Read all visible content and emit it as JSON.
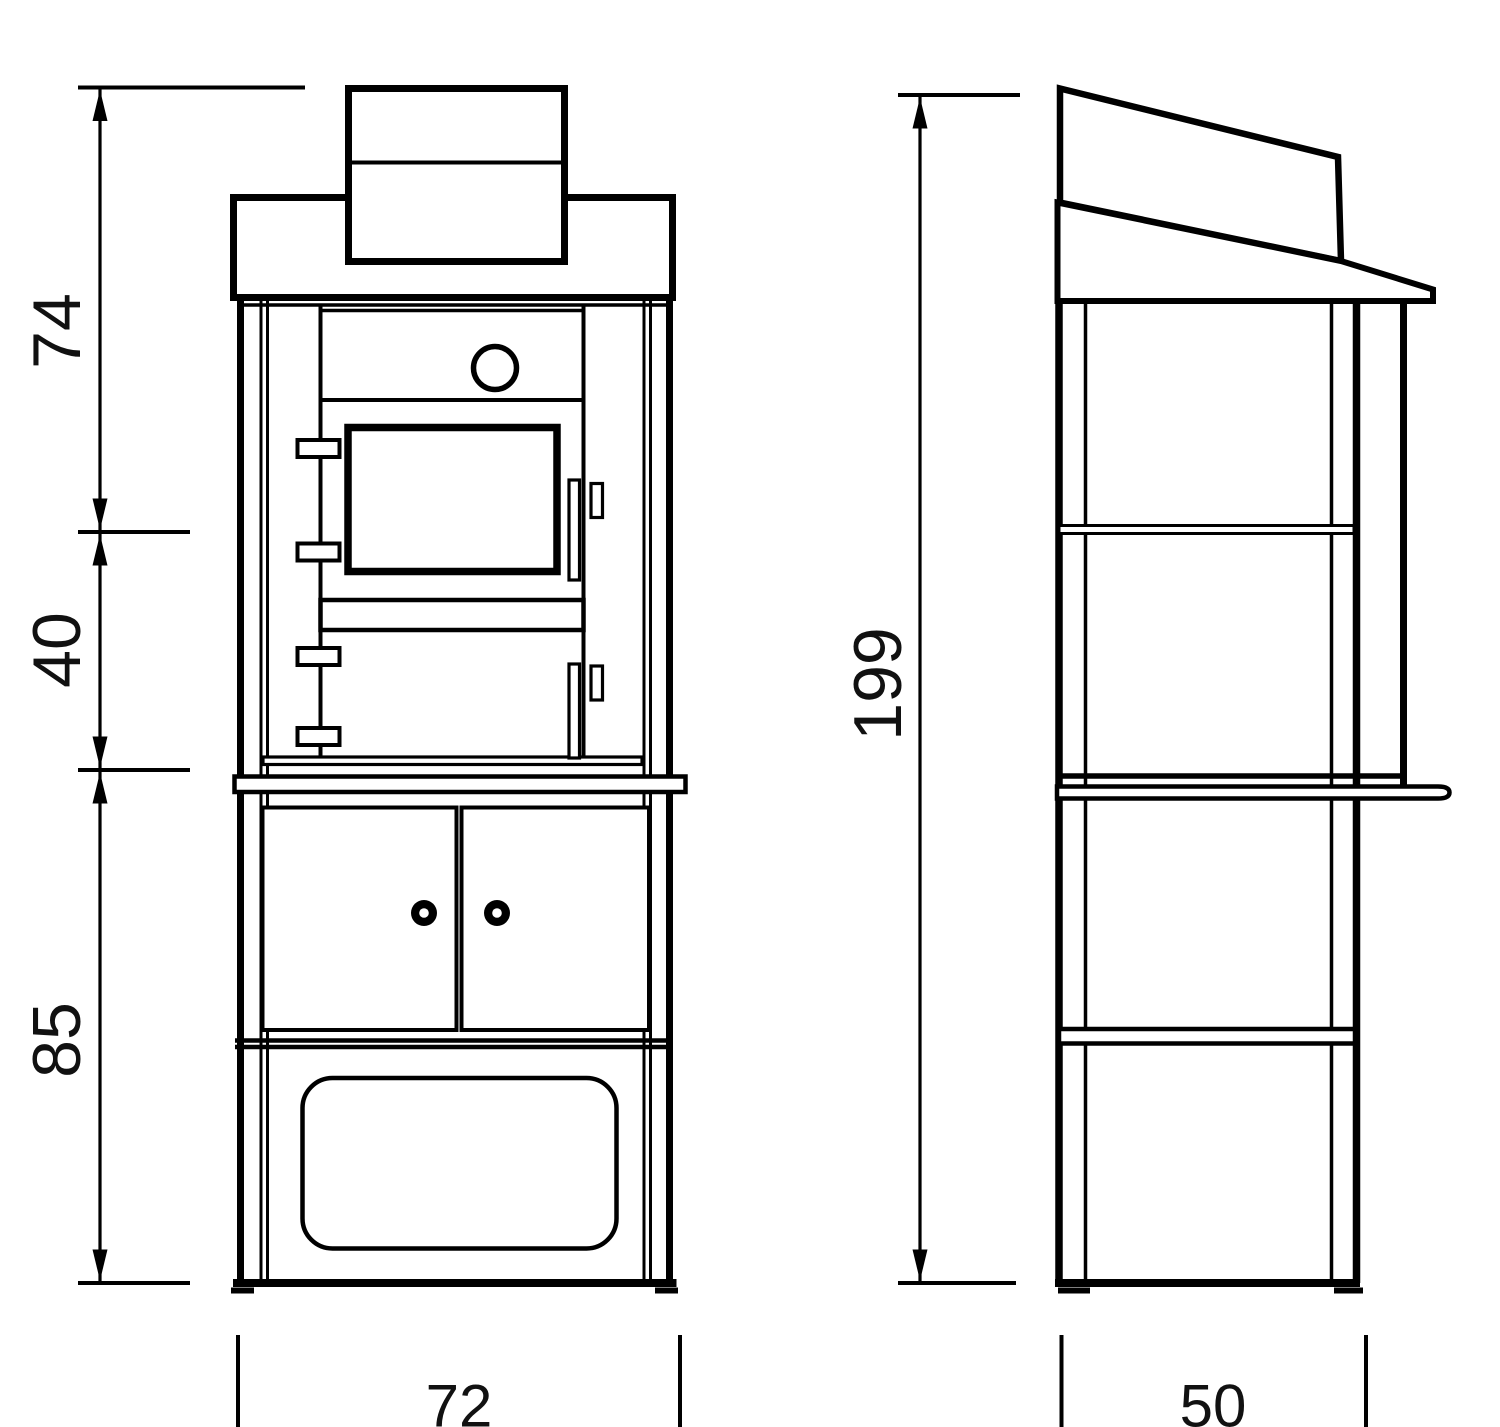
{
  "canvas": {
    "background": "#ffffff",
    "line_color": "#000000",
    "text_color": "#111111"
  },
  "dimensions": {
    "height_top": "74",
    "height_middle": "40",
    "height_lower": "85",
    "height_total": "199",
    "width_front": "72",
    "depth_side": "50"
  }
}
